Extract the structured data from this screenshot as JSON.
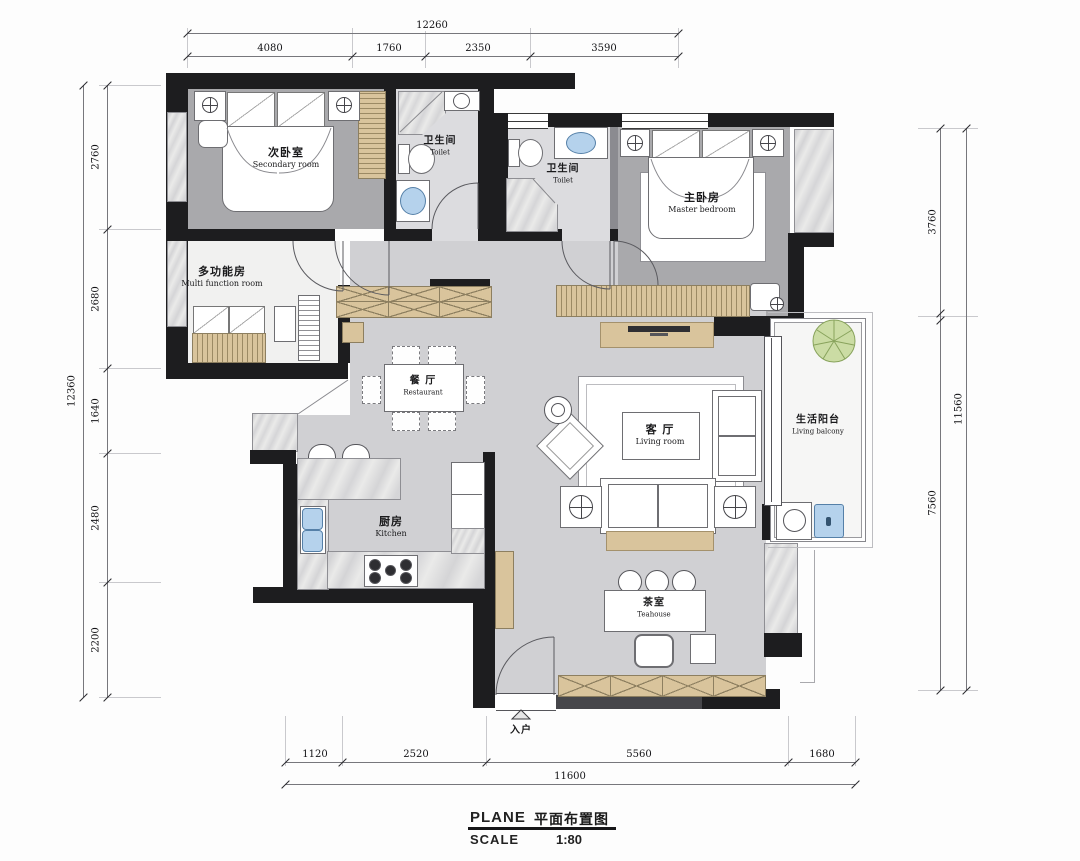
{
  "title_block": {
    "plane_label": "PLANE",
    "plane_title": "平面布置图",
    "scale_label": "SCALE",
    "scale_value": "1:80"
  },
  "entrance": {
    "label": "入户"
  },
  "rooms": {
    "secondary": {
      "zh": "次卧室",
      "en": "Secondary room"
    },
    "toilet1": {
      "zh": "卫生间",
      "en": "Toilet"
    },
    "toilet2": {
      "zh": "卫生间",
      "en": "Toilet"
    },
    "master": {
      "zh": "主卧房",
      "en": "Master bedroom"
    },
    "multi": {
      "zh": "多功能房",
      "en": "Multi function room"
    },
    "dining": {
      "zh": "餐 厅",
      "en": "Restaurant"
    },
    "living": {
      "zh": "客 厅",
      "en": "Living room"
    },
    "balcony": {
      "zh": "生活阳台",
      "en": "Living balcony"
    },
    "kitchen": {
      "zh": "厨房",
      "en": "Kitchen"
    },
    "teahouse": {
      "zh": "茶室",
      "en": "Teahouse"
    }
  },
  "dimensions": {
    "top": {
      "total": "12260",
      "segments": [
        "4080",
        "1760",
        "2350",
        "3590"
      ]
    },
    "bottom": {
      "total": "11600",
      "segments": [
        "1120",
        "2520",
        "5560",
        "1680"
      ]
    },
    "left": {
      "total": "12360",
      "segments": [
        "2760",
        "2680",
        "1640",
        "2480",
        "2200"
      ]
    },
    "right": {
      "total": "11560",
      "segments": [
        "3760",
        "7560"
      ]
    }
  },
  "colors": {
    "wall": "#1d1d1f",
    "wood_cabinet": "#d9c49c",
    "water_fixture": "#b5d2ec",
    "plant": "#cbdca4",
    "floor_bedroom": "#a9a9ac",
    "floor_living": "#d0d0d3"
  }
}
